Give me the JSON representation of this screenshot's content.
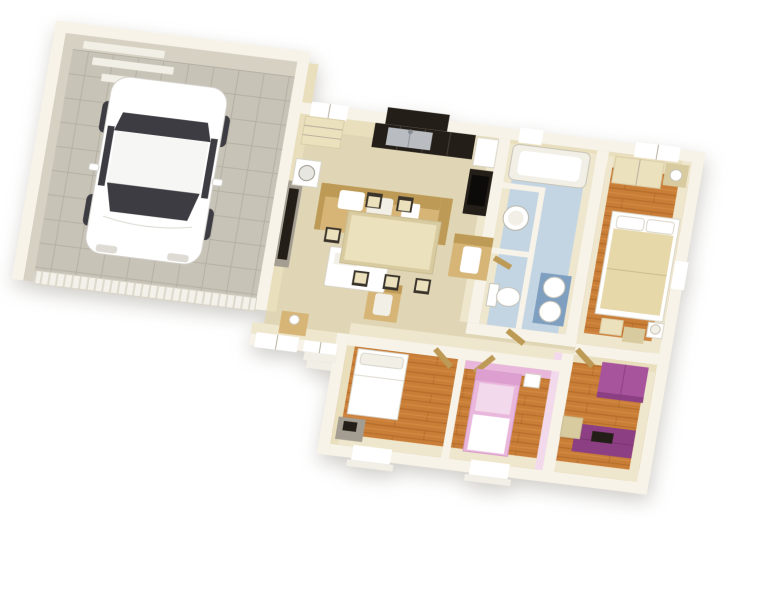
{
  "canvas": {
    "width": 780,
    "height": 600,
    "background": "#ffffff"
  },
  "view": {
    "type": "isometric-3d-floor-plan",
    "style": "dollhouse cutaway render"
  },
  "palette": {
    "wall_top": "#f7f3e8",
    "wall_face": "#e9dfbd",
    "wall_face_light": "#efe7cd",
    "garage_wall": "#d7d1c3",
    "floor_garage": "#c8c3b7",
    "floor_living": "#e0d6b6",
    "floor_bath": "#c3d4e2",
    "floor_wood": "#c97e38",
    "wood_line": "#a25f1e",
    "furn_tan": "#d6b577",
    "furn_tan_dark": "#bd9a55",
    "furn_cream": "#ece1bd",
    "furn_cream_dark": "#d9cba0",
    "duvet": "#e7d8a9",
    "white": "#ffffff",
    "off_white": "#f2efe6",
    "dark": "#241e18",
    "glass": "#3c3c42",
    "gray": "#a49e92",
    "steel": "#b9bdc2",
    "purple": "#a8549c",
    "purple_dark": "#8c3f82",
    "pink": "#e9b7dc",
    "pink_light": "#f3d9ec",
    "blue_cabinet": "#7f9fc0",
    "line": "#b4ad9c"
  },
  "scene": {
    "rooms": [
      {
        "name": "garage",
        "floor": "gray-tile",
        "contents": [
          "white-car",
          "wall-shelves",
          "washing-machine",
          "ribbed-garage-door"
        ]
      },
      {
        "name": "living-room",
        "floor": "beige",
        "contents": [
          "tv-panel",
          "sofa",
          "armchair",
          "side-chair",
          "coffee-table",
          "hall-console-lamp"
        ]
      },
      {
        "name": "kitchen",
        "floor": "beige",
        "contents": [
          "dark-base-cabinets",
          "steel-sink",
          "upper-cabinet",
          "fridge",
          "cooktop",
          "sideboard"
        ]
      },
      {
        "name": "dining-area",
        "floor": "beige",
        "contents": [
          "dining-table",
          "six-chairs"
        ]
      },
      {
        "name": "laundry-room",
        "floor": "blue",
        "contents": [
          "round-basin"
        ]
      },
      {
        "name": "wc",
        "floor": "blue",
        "contents": [
          "toilet"
        ]
      },
      {
        "name": "bathroom",
        "floor": "blue",
        "contents": [
          "bathtub",
          "double-sink-vanity"
        ]
      },
      {
        "name": "master-bedroom",
        "floor": "wood",
        "contents": [
          "double-bed",
          "wardrobe",
          "dresser-lamp",
          "bench",
          "nightstand-lamp"
        ]
      },
      {
        "name": "bedroom-2",
        "floor": "wood",
        "contents": [
          "single-bed-white",
          "desk-with-monitor"
        ]
      },
      {
        "name": "bedroom-3",
        "floor": "wood",
        "contents": [
          "single-bed-pink",
          "nightstand",
          "pink-walls"
        ]
      },
      {
        "name": "bedroom-4",
        "floor": "wood",
        "contents": [
          "purple-wardrobe",
          "purple-desk-with-monitor",
          "desk-chair"
        ]
      },
      {
        "name": "hallway",
        "floor": "beige",
        "contents": [
          "open-doors"
        ]
      }
    ],
    "exterior": [
      "white-cut-wall-tops",
      "entrance-steps",
      "window-sills"
    ]
  }
}
